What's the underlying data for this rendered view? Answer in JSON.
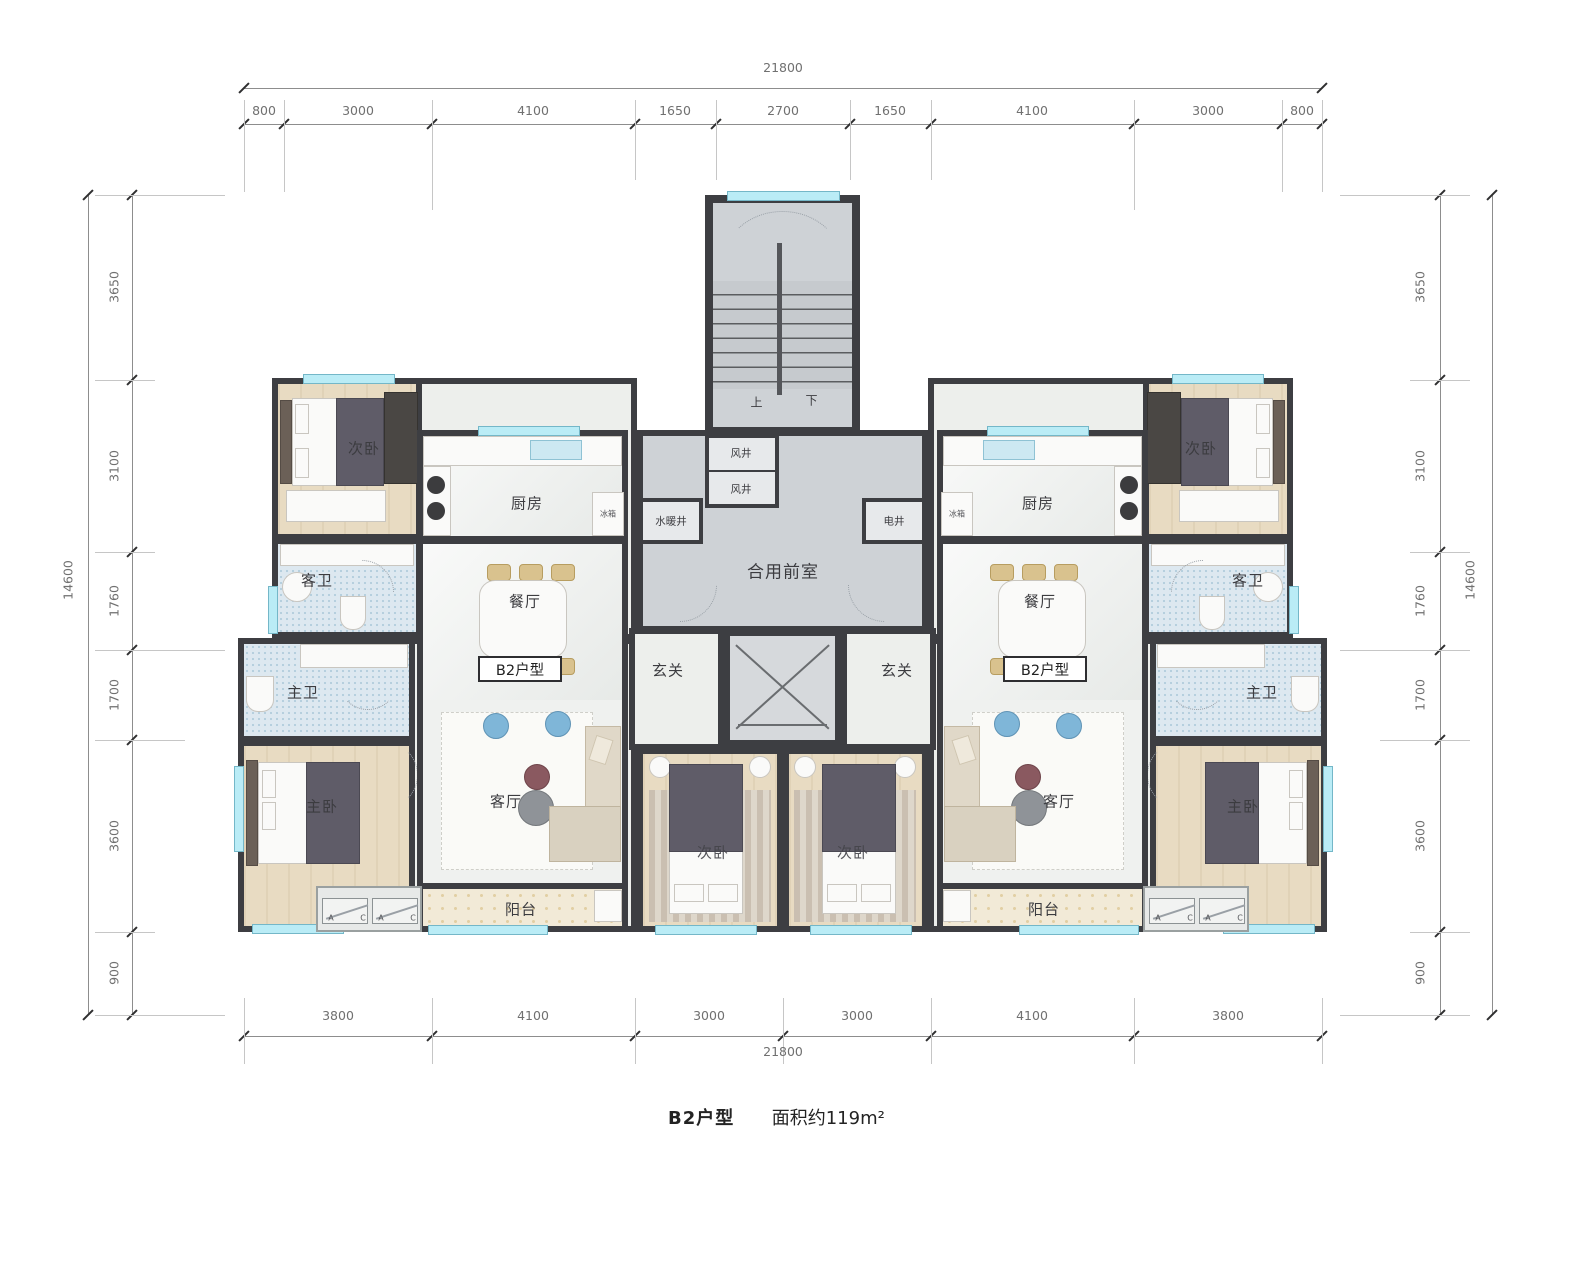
{
  "dims": {
    "top": {
      "total": "21800",
      "segments": [
        "800",
        "3000",
        "4100",
        "1650",
        "2700",
        "1650",
        "4100",
        "3000",
        "800"
      ]
    },
    "bottom": {
      "total": "21800",
      "segments": [
        "3800",
        "4100",
        "3000",
        "3000",
        "4100",
        "3800"
      ]
    },
    "left": {
      "total": "14600",
      "segments": [
        "3650",
        "3100",
        "1760",
        "1700",
        "3600",
        "900"
      ]
    },
    "right": {
      "total": "14600",
      "segments": [
        "3650",
        "3100",
        "1760",
        "1700",
        "3600",
        "900"
      ]
    }
  },
  "core": {
    "shared_lobby": "合用前室",
    "wind_shaft_1": "风井",
    "wind_shaft_2": "风井",
    "plumbing_shaft": "水暖井",
    "electrical_shaft": "电井",
    "stair_up": "上",
    "stair_down": "下"
  },
  "left_unit": {
    "type_tag": "B2户型",
    "bedroom2": "次卧",
    "kitchen": "厨房",
    "fridge": "冰箱",
    "guest_bath": "客卫",
    "dining": "餐厅",
    "foyer": "玄关",
    "master_bath": "主卫",
    "master_bedroom": "主卧",
    "living": "客厅",
    "balcony": "阳台",
    "center_bedroom": "次卧"
  },
  "right_unit": {
    "type_tag": "B2户型",
    "bedroom2": "次卧",
    "kitchen": "厨房",
    "fridge": "冰箱",
    "guest_bath": "客卫",
    "dining": "餐厅",
    "foyer": "玄关",
    "master_bath": "主卫",
    "master_bedroom": "主卧",
    "living": "客厅",
    "balcony": "阳台",
    "center_bedroom": "次卧"
  },
  "ac_pad": {
    "a": "A",
    "c": "C"
  },
  "caption": {
    "unit_type": "B2户型",
    "area": "面积约119m²"
  },
  "colors": {
    "wall": "#3d3e42",
    "window": "#baecf6",
    "tile_floor": "#dde8f0",
    "wood_floor": "#e8dbc2",
    "core_floor": "#ced2d6",
    "balcony_floor": "#f2ead7"
  }
}
